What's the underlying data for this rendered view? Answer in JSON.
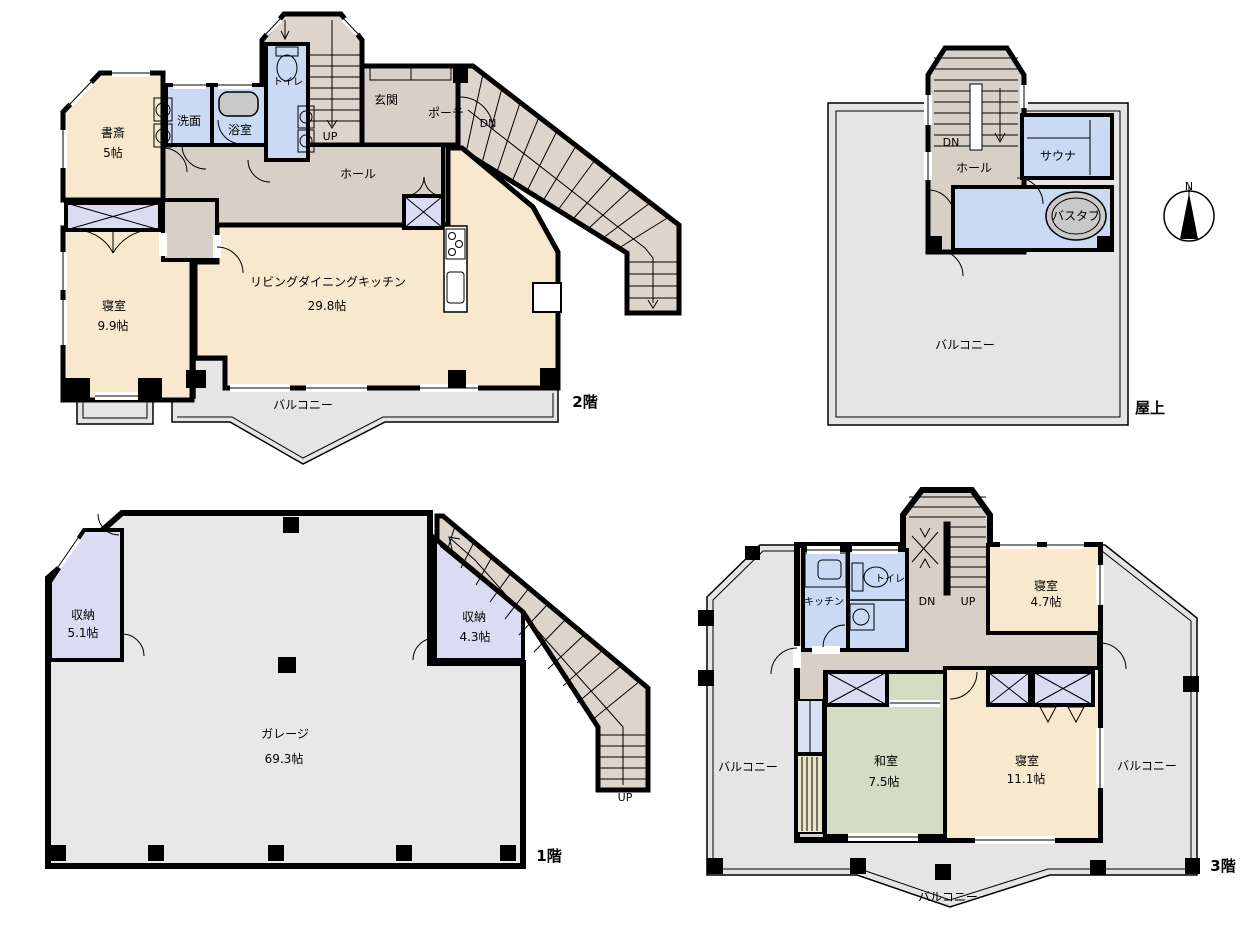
{
  "floors": {
    "f2": {
      "floor_label": "2階",
      "study": "書斎",
      "study_size": "5帖",
      "washroom": "洗面",
      "bath": "浴室",
      "toilet": "トイレ",
      "up": "UP",
      "entrance": "玄関",
      "porch": "ポーチ",
      "dn": "DN",
      "hall": "ホール",
      "ldk": "リビングダイニングキッチン",
      "ldk_size": "29.8帖",
      "bedroom": "寝室",
      "bedroom_size": "9.9帖",
      "balcony": "バルコニー"
    },
    "roof": {
      "floor_label": "屋上",
      "dn": "DN",
      "hall": "ホール",
      "sauna": "サウナ",
      "bathtub": "バスタブ",
      "balcony": "バルコニー",
      "compass_n": "N"
    },
    "f1": {
      "floor_label": "1階",
      "storage1": "収納",
      "storage1_size": "5.1帖",
      "storage2": "収納",
      "storage2_size": "4.3帖",
      "garage": "ガレージ",
      "garage_size": "69.3帖",
      "up": "UP"
    },
    "f3": {
      "floor_label": "3階",
      "kitchen": "キッチン",
      "toilet": "トイレ",
      "dn": "DN",
      "up": "UP",
      "bedroom_small": "寝室",
      "bedroom_small_size": "4.7帖",
      "washitsu": "和室",
      "washitsu_size": "7.5帖",
      "bedroom_large": "寝室",
      "bedroom_large_size": "11.1帖",
      "balcony_left": "バルコニー",
      "balcony_right": "バルコニー",
      "balcony_bottom": "バルコニー"
    }
  },
  "colors": {
    "room_cream": "#F8E9CE",
    "water_blue": "#CBDAF4",
    "hall_taupe": "#D8CFC7",
    "stair_taupe": "#DDD4CB",
    "storage_lavender": "#DBDBF4",
    "outdoor_gray": "#E5E5E5",
    "tatami_green": "#D4DCC3",
    "tatami_strip": "#EAE6C8",
    "fixture_gray": "#C9C9C9",
    "wall_black": "#000000"
  }
}
